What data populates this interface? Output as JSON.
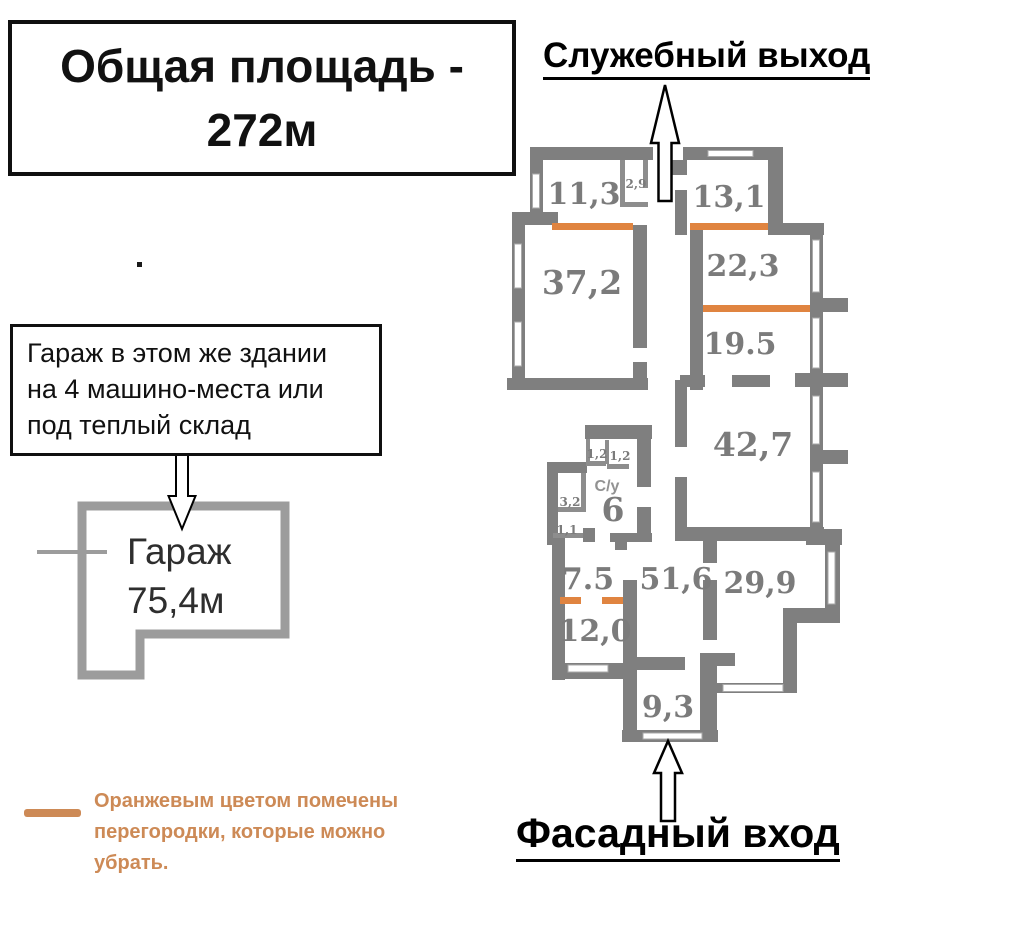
{
  "title_box": {
    "line1": "Общая площадь -",
    "line2": "272м"
  },
  "headings": {
    "service_exit": "Служебный выход",
    "facade_entrance": "Фасадный вход"
  },
  "garage_note": {
    "line1": "Гараж в этом же здании",
    "line2": "на 4 машино-места или",
    "line3": "под теплый склад"
  },
  "garage": {
    "name": "Гараж",
    "area": "75,4м"
  },
  "legend": {
    "line1": "Оранжевым цветом помечены",
    "line2": "перегородки, которые можно",
    "line3": "убрать."
  },
  "plan": {
    "total_area": "272м",
    "rooms": [
      {
        "label": "11,3"
      },
      {
        "label": "2,9"
      },
      {
        "label": "13,1"
      },
      {
        "label": "37,2"
      },
      {
        "label": "22,3"
      },
      {
        "label": "19.5"
      },
      {
        "label": "42,7"
      },
      {
        "label": "1,2"
      },
      {
        "label": "1,2"
      },
      {
        "label": "С/у"
      },
      {
        "label": "6"
      },
      {
        "label": "3,2"
      },
      {
        "label": "1,1"
      },
      {
        "label": "7.5"
      },
      {
        "label": "51,6"
      },
      {
        "label": "29,9"
      },
      {
        "label": "12,0"
      },
      {
        "label": "9,3"
      }
    ]
  },
  "colors": {
    "wall": "#7f7f7f",
    "garage_wall": "#9c9c9c",
    "removable_partition": "#e08440",
    "legend_text": "#cd8a56",
    "room_label": "#7b7b7b"
  }
}
